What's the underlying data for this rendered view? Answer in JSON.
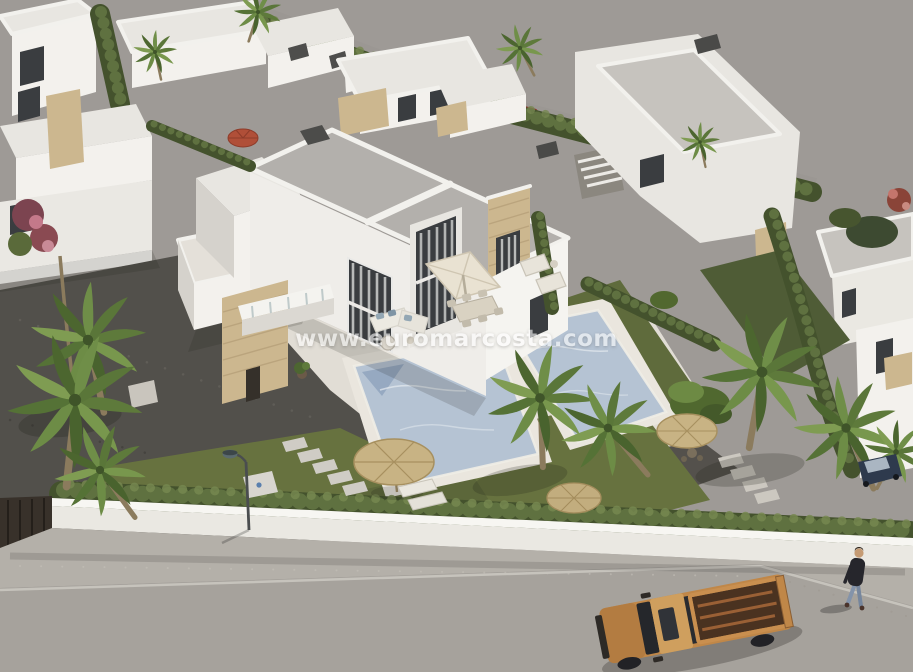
{
  "image": {
    "type": "3d-architectural-render",
    "description": "Aerial 3D render of a modern white villa development: central duplex villa with two private pools, travertine terraces, palm trees, straw parasols, perimeter wall with hedge, and a street with an orange pickup truck and a pedestrian.",
    "watermark": "www.euromarcosta.com"
  },
  "palette": {
    "sky_gray": "#9e9a96",
    "road_gray": "#a6a29c",
    "sidewalk_gray": "#b4b0a9",
    "wall_white": "#eae8e2",
    "roof_gray": "#b3b0ac",
    "stone_beige": "#ccb78f",
    "hedge_green": "#44522d",
    "lawn_green": "#67723f",
    "gravel_dark": "#52504b",
    "pool_blue": "#b5c3d3",
    "deck_light": "#e1ddd5",
    "truck_orange": "#c08748",
    "gate_brown": "#38312a",
    "watermark_white": "#ffffff"
  },
  "scene": {
    "objects": [
      "white flat-roof villas",
      "central duplex villa",
      "two swimming pools",
      "palm trees",
      "straw umbrellas with sun loungers",
      "white square parasol with dining set",
      "perimeter wall and hedge",
      "street lamp",
      "orange pickup truck",
      "pedestrian on sidewalk",
      "parked cars behind rear hedge"
    ]
  }
}
